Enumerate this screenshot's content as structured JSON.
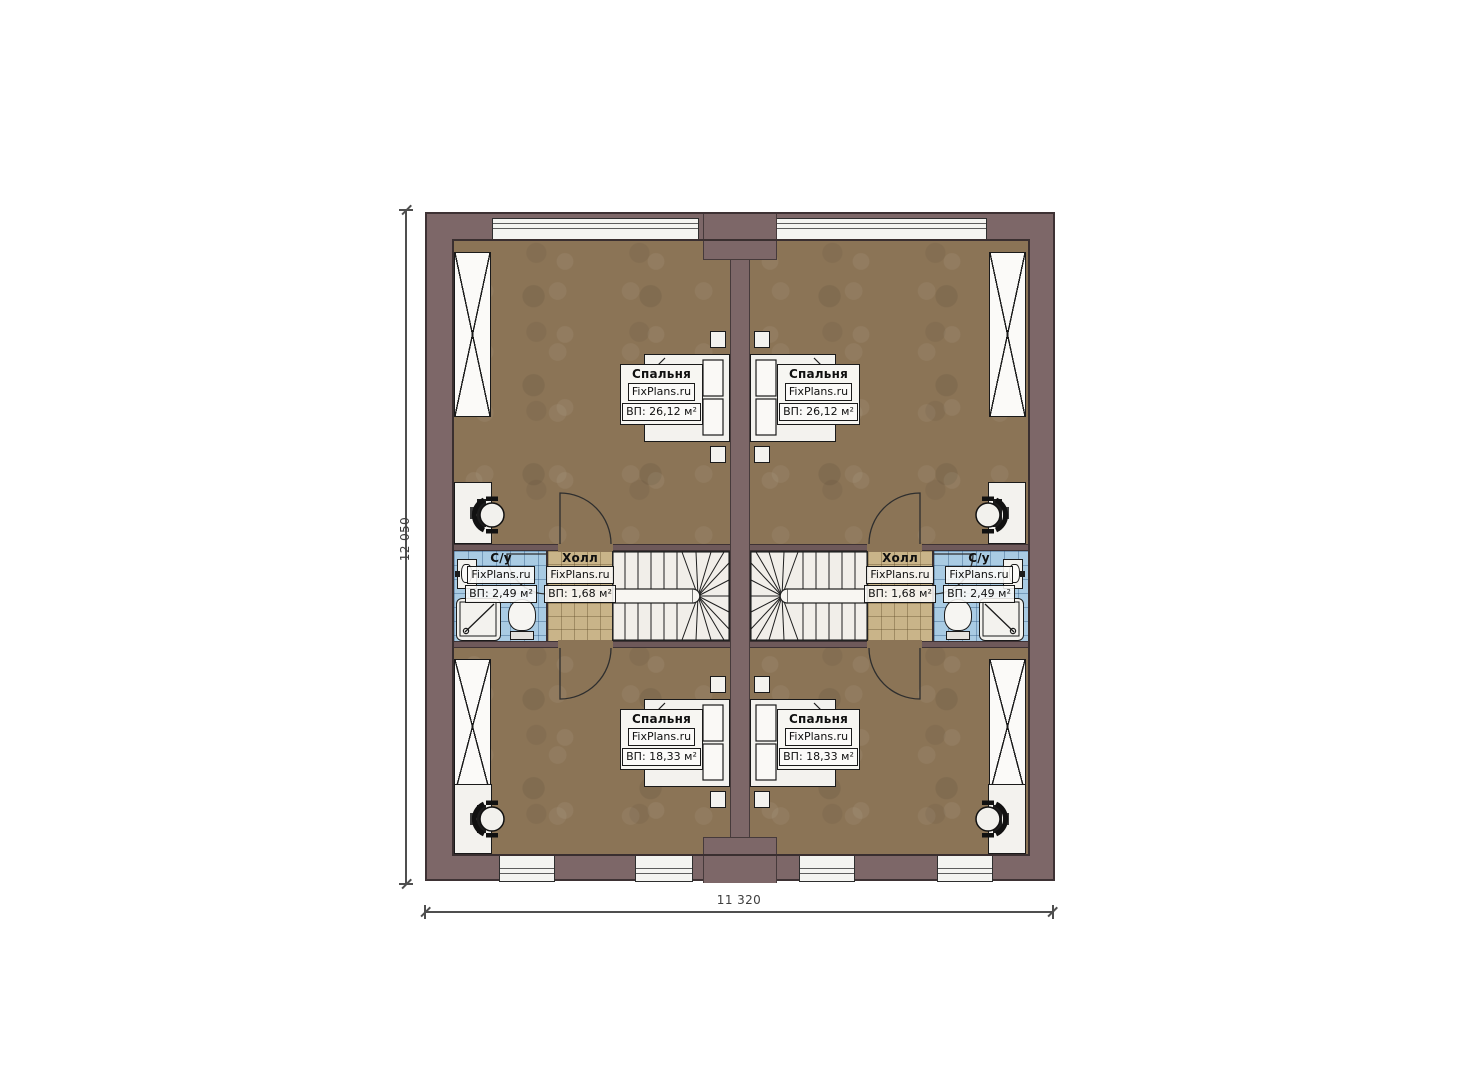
{
  "plan": {
    "brand": "FixPlans.ru",
    "dimensions": {
      "vertical": "12 050",
      "horizontal": "11 320"
    },
    "rooms": {
      "bedroom_top_left": {
        "name": "Спальня",
        "brand": "FixPlans.ru",
        "area": "ВП: 26,12 м²"
      },
      "bedroom_top_right": {
        "name": "Спальня",
        "brand": "FixPlans.ru",
        "area": "ВП: 26,12 м²"
      },
      "bedroom_bottom_left": {
        "name": "Спальня",
        "brand": "FixPlans.ru",
        "area": "ВП: 18,33 м²"
      },
      "bedroom_bottom_right": {
        "name": "Спальня",
        "brand": "FixPlans.ru",
        "area": "ВП: 18,33 м²"
      },
      "hall_left": {
        "name": "Холл",
        "brand": "FixPlans.ru",
        "area": "ВП: 1,68 м²"
      },
      "hall_right": {
        "name": "Холл",
        "brand": "FixPlans.ru",
        "area": "ВП: 1,68 м²"
      },
      "bathroom_left": {
        "name": "С/у",
        "brand": "FixPlans.ru",
        "area": "ВП: 2,49 м²"
      },
      "bathroom_right": {
        "name": "С/у",
        "brand": "FixPlans.ru",
        "area": "ВП: 2,49 м²"
      }
    },
    "colors": {
      "wall": "#7d6768",
      "bedroom_floor": "#8b7456",
      "hall_floor": "#c9b489",
      "bath_floor": "#a9cbe3",
      "fixture": "#f3f2ee"
    }
  }
}
